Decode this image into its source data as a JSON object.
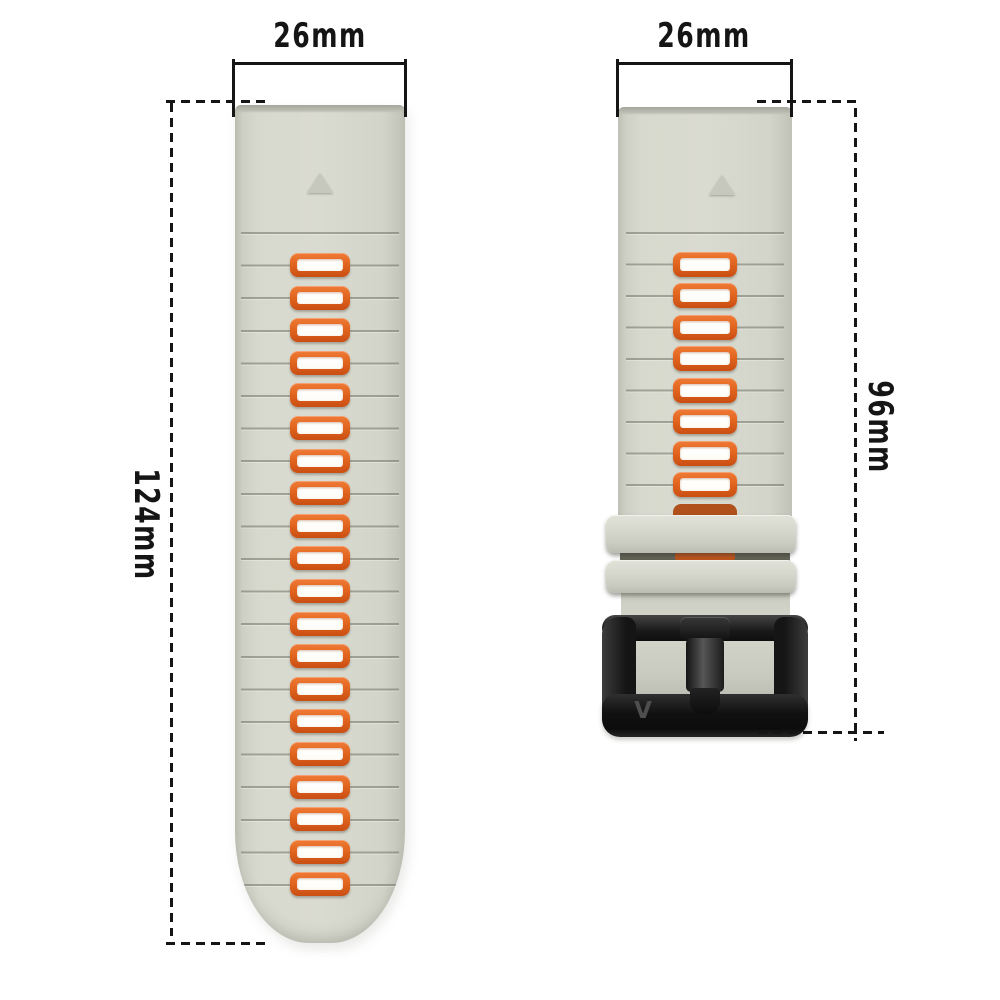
{
  "annotations": {
    "left_width_label": "26mm",
    "right_width_label": "26mm",
    "left_length_label": "124mm",
    "right_length_label": "96mm"
  },
  "straps": {
    "left": {
      "slot_count": 20
    },
    "right": {
      "slot_count": 9
    }
  },
  "buckle": {
    "logo": "V"
  },
  "colors": {
    "background": "#ffffff",
    "dimension_ink": "#151515",
    "strap_body": "#d8d9ce",
    "slot_orange": "#d9571b",
    "buckle_black": "#1b1b1b"
  }
}
